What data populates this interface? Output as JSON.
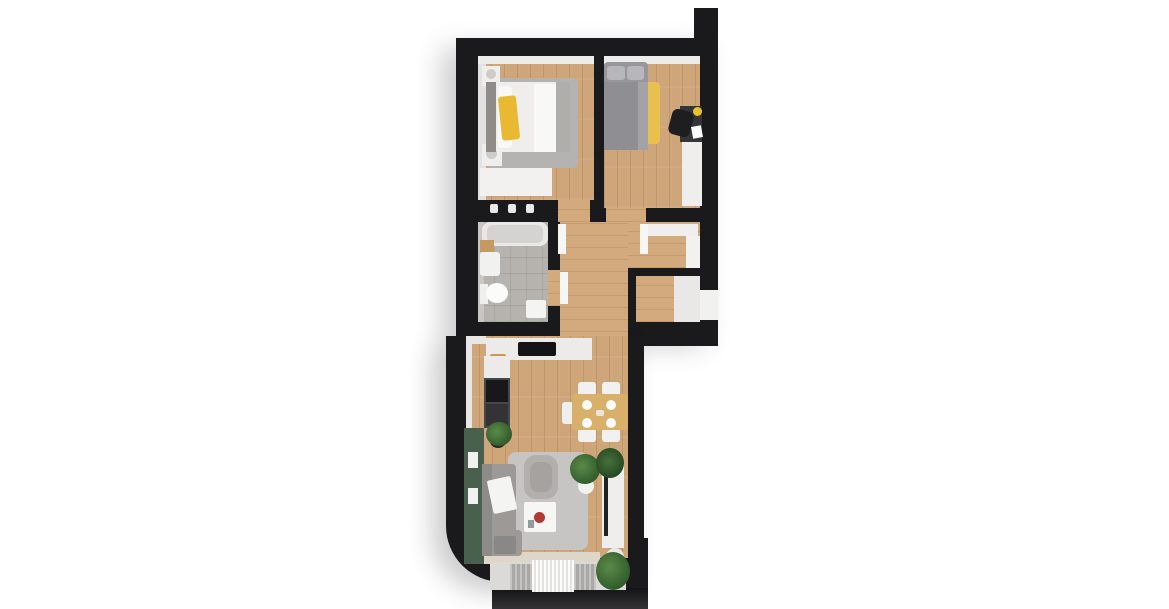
{
  "scene": {
    "title": "3D top-view apartment floor plan render",
    "background": "#ffffff"
  },
  "palette": {
    "wall": "#1a1a1c",
    "wood_floor": "#cfa67a",
    "hall_wood": "#d2aa7e",
    "bathroom_tile": "#b6b2ae",
    "green_accent_wall": "#4a604e",
    "yellow_accent": "#e9b931",
    "sofa_gray": "#9c9996",
    "white_furniture": "#f2f1f0",
    "balcony_floor": "#dbdad8"
  },
  "rooms": [
    {
      "name": "bedroom-1",
      "furniture": [
        "double-bed",
        "yellow-throw",
        "gray-rug",
        "two-nightstands-with-lamps",
        "dresser"
      ]
    },
    {
      "name": "bedroom-2",
      "furniture": [
        "bed-gray-bedding",
        "yellow-rug",
        "desk",
        "black-desk-chair",
        "wardrobe"
      ]
    },
    {
      "name": "bathroom",
      "furniture": [
        "bathtub",
        "sink",
        "toilet",
        "wood-shelf",
        "bath-mat"
      ]
    },
    {
      "name": "hallway",
      "furniture": [
        "low-cabinet",
        "tall-wardrobe",
        "open-door-leaves"
      ]
    },
    {
      "name": "entry-alcove",
      "furniture": [
        "floor-mat",
        "entry-door-opening"
      ]
    },
    {
      "name": "living-room-with-kitchen",
      "furniture": [
        "l-shaped-counter",
        "cooktop",
        "oven",
        "fridge",
        "green-accent-wall",
        "l-shaped-sofa",
        "armchair",
        "coffee-table",
        "gray-rug",
        "dining-table",
        "five-chairs",
        "tv-console",
        "plants"
      ]
    },
    {
      "name": "balcony",
      "furniture": [
        "striped-mat",
        "potted-plant"
      ]
    }
  ],
  "shapes": [
    {
      "n": "building-upper-block",
      "k": "wall shadowed",
      "x": 456,
      "y": 38,
      "w": 262,
      "h": 298
    },
    {
      "n": "roof-notch",
      "k": "wall",
      "x": 694,
      "y": 8,
      "w": 24,
      "h": 34
    },
    {
      "n": "building-lower-block",
      "k": "wall shadowed",
      "x": 446,
      "y": 336,
      "w": 198,
      "h": 246,
      "r": "0 0 0 56px"
    },
    {
      "n": "wall-step-right",
      "k": "wall",
      "x": 628,
      "y": 336,
      "w": 90,
      "h": 10
    },
    {
      "n": "balcony-right-wall",
      "k": "wall",
      "x": 626,
      "y": 538,
      "w": 22,
      "h": 54
    },
    {
      "n": "balcony-front-edge",
      "k": "front-band",
      "x": 492,
      "y": 588,
      "w": 156,
      "h": 21
    },
    {
      "n": "bedroom1-floor",
      "k": "wood-v",
      "x": 478,
      "y": 56,
      "w": 116,
      "h": 144
    },
    {
      "n": "bedroom1-top-wall-face",
      "c": "#ececeb",
      "x": 478,
      "y": 56,
      "w": 116,
      "h": 8
    },
    {
      "n": "bedroom1-left-wall-face",
      "c": "#e2e1e0",
      "x": 478,
      "y": 64,
      "w": 8,
      "h": 136
    },
    {
      "n": "bedroom2-floor",
      "k": "wood-v",
      "x": 604,
      "y": 56,
      "w": 96,
      "h": 152
    },
    {
      "n": "bedroom2-top-wall-face",
      "c": "#ececeb",
      "x": 604,
      "y": 56,
      "w": 96,
      "h": 8
    },
    {
      "n": "bathroom-floor",
      "k": "tile",
      "x": 478,
      "y": 222,
      "w": 70,
      "h": 100
    },
    {
      "n": "bathroom-left-wall-face",
      "c": "#c9c6c3",
      "x": 478,
      "y": 222,
      "w": 6,
      "h": 100
    },
    {
      "n": "hallway-floor",
      "k": "wood-h",
      "x": 560,
      "y": 222,
      "w": 140,
      "h": 46
    },
    {
      "n": "hallway-corridor-floor",
      "k": "wood-h",
      "x": 560,
      "y": 222,
      "w": 68,
      "h": 122
    },
    {
      "n": "entry-alcove-floor",
      "k": "wood-h",
      "x": 636,
      "y": 276,
      "w": 38,
      "h": 46
    },
    {
      "n": "entry-alcove-mat",
      "c": "#e9e8e6",
      "x": 674,
      "y": 276,
      "w": 26,
      "h": 46
    },
    {
      "n": "entry-door-opening",
      "c": "#f1f1f0",
      "x": 700,
      "y": 290,
      "w": 18,
      "h": 30
    },
    {
      "n": "living-room-floor",
      "k": "wood-v",
      "x": 466,
      "y": 336,
      "w": 162,
      "h": 222
    },
    {
      "n": "bedroom1-door-opening",
      "k": "wood-h",
      "x": 558,
      "y": 200,
      "w": 32,
      "h": 22
    },
    {
      "n": "bedroom2-door-opening",
      "k": "wood-h",
      "x": 606,
      "y": 208,
      "w": 40,
      "h": 14
    },
    {
      "n": "bathroom-door-opening",
      "k": "wood-h",
      "x": 548,
      "y": 270,
      "w": 12,
      "h": 36
    },
    {
      "n": "balcony-threshold",
      "c": "#ded6c9",
      "x": 482,
      "y": 552,
      "w": 118,
      "h": 12
    },
    {
      "n": "balcony-floor",
      "c": "#dbdad8",
      "x": 490,
      "y": 562,
      "w": 136,
      "h": 28
    },
    {
      "n": "balcony-mat-ribbed-left",
      "k": "ribbed",
      "x": 510,
      "y": 564,
      "w": 22,
      "h": 26
    },
    {
      "n": "balcony-mat-fringe",
      "k": "fringe",
      "x": 532,
      "y": 560,
      "w": 42,
      "h": 32
    },
    {
      "n": "balcony-mat-ribbed-right",
      "k": "ribbed",
      "x": 574,
      "y": 564,
      "w": 22,
      "h": 26
    },
    {
      "n": "living-top-wall-face",
      "c": "#e8e7e6",
      "x": 466,
      "y": 336,
      "w": 20,
      "h": 8
    },
    {
      "n": "living-left-wall-face",
      "c": "#e8e7e6",
      "x": 466,
      "y": 344,
      "w": 6,
      "h": 84
    },
    {
      "n": "bedroom1-rug",
      "c": "#b5b3b1",
      "x": 486,
      "y": 78,
      "w": 92,
      "h": 90,
      "r": 6
    },
    {
      "n": "bedroom1-dresser",
      "c": "#f2f1f0",
      "x": 480,
      "y": 168,
      "w": 72,
      "h": 28
    },
    {
      "n": "nightstand-top",
      "c": "#efeeec",
      "x": 482,
      "y": 66,
      "w": 18,
      "h": 20
    },
    {
      "n": "nightstand-lamp-top",
      "c": "#cfcbc6",
      "x": 486,
      "y": 69,
      "w": 10,
      "h": 10,
      "r": "50%"
    },
    {
      "n": "nightstand-bottom",
      "c": "#efeeec",
      "x": 482,
      "y": 144,
      "w": 20,
      "h": 22
    },
    {
      "n": "nightstand-lamp-bottom",
      "c": "#cfcbc6",
      "x": 486,
      "y": 148,
      "w": 11,
      "h": 11,
      "r": "50%"
    },
    {
      "n": "bed1-headboard",
      "c": "#8e8b89",
      "x": 486,
      "y": 82,
      "w": 10,
      "h": 70
    },
    {
      "n": "bed1-mattress",
      "c": "#efeeec",
      "x": 496,
      "y": 82,
      "w": 74,
      "h": 70,
      "r": 4
    },
    {
      "n": "bed1-pillow",
      "c": "#f8f8f7",
      "x": 498,
      "y": 86,
      "w": 14,
      "h": 62,
      "r": 3
    },
    {
      "n": "bed1-sheet-fold",
      "c": "#f8f8f7",
      "x": 534,
      "y": 84,
      "w": 22,
      "h": 68
    },
    {
      "n": "bed1-end-blanket",
      "c": "#b0aeab",
      "x": 556,
      "y": 82,
      "w": 14,
      "h": 70
    },
    {
      "n": "bed1-yellow-throw",
      "c": "#e9b931",
      "x": 500,
      "y": 96,
      "w": 18,
      "h": 44,
      "r": 3,
      "o": -6
    },
    {
      "n": "bathtub",
      "c": "#e9e8e7",
      "x": 482,
      "y": 222,
      "w": 66,
      "h": 24,
      "r": 8
    },
    {
      "n": "bathtub-basin",
      "c": "#d5d3d1",
      "x": 487,
      "y": 225,
      "w": 56,
      "h": 18,
      "r": 6
    },
    {
      "n": "shower-knob-1",
      "c": "#e8e8e8",
      "x": 490,
      "y": 204,
      "w": 8,
      "h": 9,
      "r": 2
    },
    {
      "n": "shower-knob-2",
      "c": "#e8e8e8",
      "x": 508,
      "y": 204,
      "w": 8,
      "h": 9,
      "r": 2
    },
    {
      "n": "shower-knob-3",
      "c": "#e8e8e8",
      "x": 526,
      "y": 204,
      "w": 8,
      "h": 9,
      "r": 2
    },
    {
      "n": "bath-wood-shelf",
      "c": "#c59a62",
      "x": 480,
      "y": 240,
      "w": 14,
      "h": 12
    },
    {
      "n": "bathroom-sink",
      "c": "#f1f1f0",
      "x": 480,
      "y": 252,
      "w": 20,
      "h": 24,
      "r": 3
    },
    {
      "n": "toilet-tank",
      "c": "#efefee",
      "x": 480,
      "y": 284,
      "w": 8,
      "h": 20
    },
    {
      "n": "toilet-bowl",
      "c": "#fbfbfa",
      "x": 486,
      "y": 283,
      "w": 22,
      "h": 20,
      "r": "50%"
    },
    {
      "n": "bath-mat",
      "c": "#f4f4f3",
      "x": 526,
      "y": 300,
      "w": 20,
      "h": 18,
      "r": 2
    },
    {
      "n": "hallway-cabinet",
      "c": "#f0efee",
      "x": 648,
      "y": 224,
      "w": 50,
      "h": 12
    },
    {
      "n": "hallway-wardrobe",
      "c": "#f2f1f0",
      "x": 686,
      "y": 236,
      "w": 14,
      "h": 32
    },
    {
      "n": "bedroom1-door-leaf",
      "c": "#f6f6f5",
      "x": 558,
      "y": 224,
      "w": 8,
      "h": 30
    },
    {
      "n": "bedroom2-door-leaf",
      "c": "#f6f6f5",
      "x": 640,
      "y": 224,
      "w": 8,
      "h": 30
    },
    {
      "n": "bathroom-door-leaf",
      "c": "#f6f6f5",
      "x": 560,
      "y": 272,
      "w": 8,
      "h": 32
    },
    {
      "n": "bedroom2-yellow-rug",
      "c": "#e8c04d",
      "x": 608,
      "y": 82,
      "w": 52,
      "h": 62,
      "r": 4
    },
    {
      "n": "bed2-mattress",
      "c": "#98969a",
      "x": 604,
      "y": 62,
      "w": 44,
      "h": 88,
      "r": 4
    },
    {
      "n": "bed2-pillow-1",
      "c": "#b7b6ba",
      "x": 607,
      "y": 66,
      "w": 18,
      "h": 14,
      "r": 3
    },
    {
      "n": "bed2-pillow-2",
      "c": "#b7b6ba",
      "x": 627,
      "y": 66,
      "w": 17,
      "h": 14,
      "r": 3
    },
    {
      "n": "bed2-duvet",
      "c": "#8f8e92",
      "x": 604,
      "y": 82,
      "w": 44,
      "h": 68
    },
    {
      "n": "bed2-duvet-fold",
      "c": "#a3a2a6",
      "x": 638,
      "y": 82,
      "w": 10,
      "h": 68
    },
    {
      "n": "bedroom2-desk",
      "c": "#353538",
      "x": 680,
      "y": 106,
      "w": 22,
      "h": 36
    },
    {
      "n": "desk-chair",
      "c": "#1e1e20",
      "x": 670,
      "y": 110,
      "w": 22,
      "h": 26,
      "r": 6,
      "o": 15
    },
    {
      "n": "desk-lamp",
      "c": "#eac22e",
      "x": 693,
      "y": 107,
      "w": 9,
      "h": 9,
      "r": "50%"
    },
    {
      "n": "desk-paper",
      "c": "#fafafa",
      "x": 692,
      "y": 126,
      "w": 10,
      "h": 12,
      "o": -10
    },
    {
      "n": "bedroom2-wardrobe",
      "c": "#efeeed",
      "x": 682,
      "y": 142,
      "w": 20,
      "h": 64
    },
    {
      "n": "kitchen-counter-top",
      "c": "#edebe9",
      "x": 486,
      "y": 338,
      "w": 106,
      "h": 22
    },
    {
      "n": "cooktop",
      "c": "#141416",
      "x": 518,
      "y": 342,
      "w": 38,
      "h": 14,
      "r": 2
    },
    {
      "n": "cutting-board",
      "c": "#d0964f",
      "x": 490,
      "y": 354,
      "w": 16,
      "h": 20,
      "r": 2
    },
    {
      "n": "cutting-board-food",
      "c": "#a14a2c",
      "x": 493,
      "y": 358,
      "w": 9,
      "h": 8,
      "r": "50%"
    },
    {
      "n": "kitchen-counter-left",
      "c": "#edebe9",
      "x": 484,
      "y": 356,
      "w": 26,
      "h": 22
    },
    {
      "n": "kitchen-cabinet-dark",
      "c": "#46474a",
      "x": 484,
      "y": 378,
      "w": 26,
      "h": 50
    },
    {
      "n": "kitchen-oven",
      "c": "#18181a",
      "x": 486,
      "y": 380,
      "w": 22,
      "h": 22
    },
    {
      "n": "kitchen-fridge",
      "c": "#333336",
      "x": 486,
      "y": 404,
      "w": 22,
      "h": 22
    },
    {
      "n": "kitchen-plant-pot",
      "c": "#27272a",
      "x": 490,
      "y": 434,
      "w": 16,
      "h": 14,
      "r": "50%"
    },
    {
      "n": "kitchen-plant",
      "k": "foliage",
      "x": 486,
      "y": 422,
      "w": 26,
      "h": 24
    },
    {
      "n": "green-accent-wall",
      "c": "#4a604e",
      "x": 464,
      "y": 428,
      "w": 20,
      "h": 136
    },
    {
      "n": "wall-frame-1",
      "c": "#f1f1f0",
      "x": 468,
      "y": 452,
      "w": 10,
      "h": 16
    },
    {
      "n": "wall-frame-2",
      "c": "#f1f1f0",
      "x": 468,
      "y": 488,
      "w": 10,
      "h": 16
    },
    {
      "n": "living-rug",
      "c": "#c7c5c3",
      "x": 508,
      "y": 452,
      "w": 80,
      "h": 98,
      "r": 8
    },
    {
      "n": "sofa",
      "c": "#9c9996",
      "x": 482,
      "y": 464,
      "w": 34,
      "h": 92,
      "r": 4
    },
    {
      "n": "sofa-bottom-arm",
      "c": "#9c9996",
      "x": 482,
      "y": 530,
      "w": 40,
      "h": 26,
      "r": 4
    },
    {
      "n": "sofa-backrest",
      "c": "#8d8b88",
      "x": 482,
      "y": 464,
      "w": 10,
      "h": 92
    },
    {
      "n": "sofa-white-blanket",
      "c": "#f4f4f3",
      "x": 490,
      "y": 478,
      "w": 24,
      "h": 34,
      "r": 2,
      "o": -12
    },
    {
      "n": "sofa-gray-blanket",
      "c": "#8a8886",
      "x": 494,
      "y": 536,
      "w": 22,
      "h": 18,
      "r": 2
    },
    {
      "n": "armchair",
      "c": "#b2afac",
      "x": 524,
      "y": 455,
      "w": 34,
      "h": 44,
      "r": 12
    },
    {
      "n": "armchair-seat",
      "c": "#a5a2a0",
      "x": 530,
      "y": 462,
      "w": 22,
      "h": 30,
      "r": 8
    },
    {
      "n": "coffee-table",
      "c": "#f6f6f5",
      "x": 524,
      "y": 502,
      "w": 32,
      "h": 30,
      "r": 2
    },
    {
      "n": "coffee-table-bowl",
      "c": "#b23a34",
      "x": 534,
      "y": 512,
      "w": 11,
      "h": 11,
      "r": "50%"
    },
    {
      "n": "coffee-table-item",
      "c": "#98999b",
      "x": 528,
      "y": 520,
      "w": 6,
      "h": 8
    },
    {
      "n": "dining-chair-1",
      "c": "#f1f1f0",
      "x": 578,
      "y": 382,
      "w": 18,
      "h": 14,
      "r": 3
    },
    {
      "n": "dining-chair-2",
      "c": "#f1f1f0",
      "x": 602,
      "y": 382,
      "w": 18,
      "h": 14,
      "r": 3
    },
    {
      "n": "dining-chair-3",
      "c": "#f1f1f0",
      "x": 578,
      "y": 428,
      "w": 18,
      "h": 14,
      "r": 3
    },
    {
      "n": "dining-chair-4",
      "c": "#f1f1f0",
      "x": 602,
      "y": 428,
      "w": 18,
      "h": 14,
      "r": 3
    },
    {
      "n": "dining-chair-head",
      "c": "#efefee",
      "x": 562,
      "y": 402,
      "w": 14,
      "h": 22,
      "r": 3
    },
    {
      "n": "dining-table",
      "c": "#d8b069",
      "x": 572,
      "y": 394,
      "w": 56,
      "h": 36,
      "r": 3
    },
    {
      "n": "plate-1",
      "c": "#fbfbfa",
      "x": 582,
      "y": 400,
      "w": 10,
      "h": 10,
      "r": "50%"
    },
    {
      "n": "plate-2",
      "c": "#fbfbfa",
      "x": 606,
      "y": 400,
      "w": 10,
      "h": 10,
      "r": "50%"
    },
    {
      "n": "plate-3",
      "c": "#fbfbfa",
      "x": 582,
      "y": 418,
      "w": 10,
      "h": 10,
      "r": "50%"
    },
    {
      "n": "plate-4",
      "c": "#fbfbfa",
      "x": 606,
      "y": 418,
      "w": 10,
      "h": 10,
      "r": "50%"
    },
    {
      "n": "table-centerpiece",
      "c": "#eae6dc",
      "x": 596,
      "y": 410,
      "w": 8,
      "h": 6,
      "r": 2
    },
    {
      "n": "plant-pot-dining",
      "c": "#f1f1f0",
      "x": 578,
      "y": 478,
      "w": 16,
      "h": 16,
      "r": "50%"
    },
    {
      "n": "plant-dining",
      "k": "foliage",
      "x": 570,
      "y": 454,
      "w": 30,
      "h": 30
    },
    {
      "n": "tv-console",
      "c": "#efeeec",
      "x": 602,
      "y": 464,
      "w": 22,
      "h": 84
    },
    {
      "n": "tv",
      "c": "#202022",
      "x": 604,
      "y": 476,
      "w": 4,
      "h": 60
    },
    {
      "n": "plant-console",
      "k": "foliage2",
      "x": 596,
      "y": 448,
      "w": 28,
      "h": 30
    },
    {
      "n": "balcony-plant-pot",
      "c": "#eae9e7",
      "x": 606,
      "y": 548,
      "w": 18,
      "h": 18,
      "r": "50%"
    },
    {
      "n": "balcony-plant",
      "k": "foliage",
      "x": 596,
      "y": 552,
      "w": 34,
      "h": 38
    }
  ]
}
